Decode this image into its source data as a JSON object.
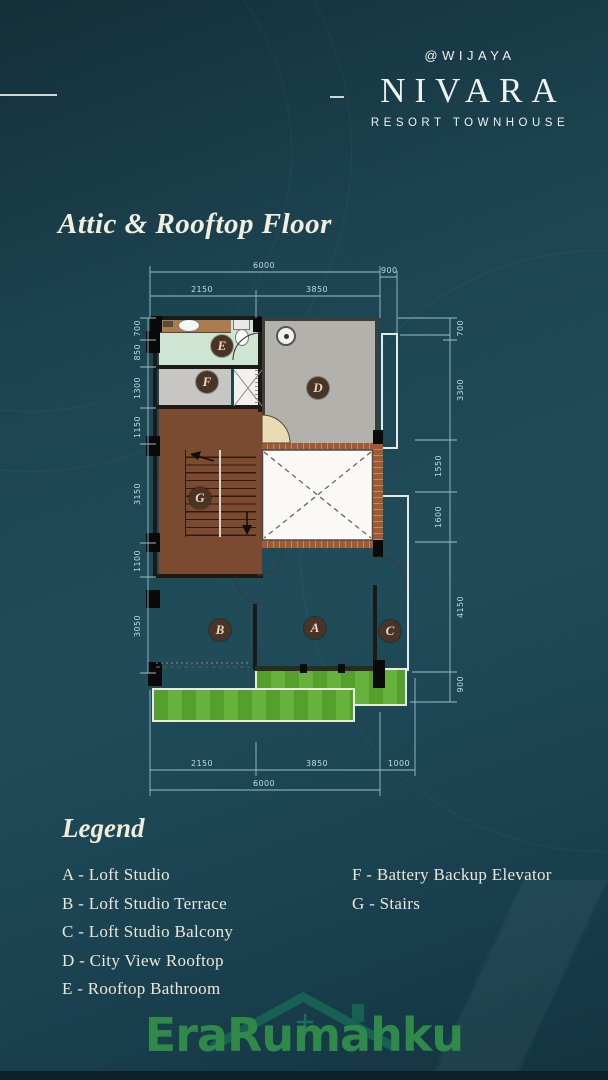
{
  "brand": {
    "handle": "@WIJAYA",
    "name": "NIVARA",
    "tagline": "RESORT TOWNHOUSE"
  },
  "page": {
    "title": "Attic & Rooftop Floor"
  },
  "plan": {
    "markers": [
      "A",
      "B",
      "C",
      "D",
      "E",
      "F",
      "G"
    ],
    "dimensions": {
      "top": [
        "6000",
        "2150",
        "3850",
        "900"
      ],
      "bottom": [
        "2150",
        "3850",
        "1000",
        "6000"
      ],
      "left": [
        "700",
        "850",
        "1300",
        "1150",
        "3150",
        "1100",
        "3050"
      ],
      "right": [
        "700",
        "3300",
        "1550",
        "1600",
        "4150",
        "900"
      ]
    }
  },
  "legend": {
    "heading": "Legend",
    "items_left": [
      "A - Loft Studio",
      "B - Loft Studio Terrace",
      "C - Loft Studio Balcony",
      "D - City View Rooftop",
      "E - Rooftop Bathroom"
    ],
    "items_right": [
      "F - Battery Backup Elevator",
      "G - Stairs"
    ]
  },
  "watermark": {
    "text": "EraRumahku"
  },
  "colors": {
    "background": "#1c4350",
    "heading_text": "#f1eedd",
    "dimension_text": "#c2dbe1",
    "watermark_green": "#2f8a4a",
    "plan": {
      "rooftop_gray": "#b3b1ac",
      "bath_mint": "#cfe5d4",
      "elevator_gray": "#c7c6c2",
      "stairs_brown": "#7a4a31",
      "wood": "#d8b37d",
      "tile": "#e5d5b4",
      "grass": "#55a02c"
    }
  }
}
